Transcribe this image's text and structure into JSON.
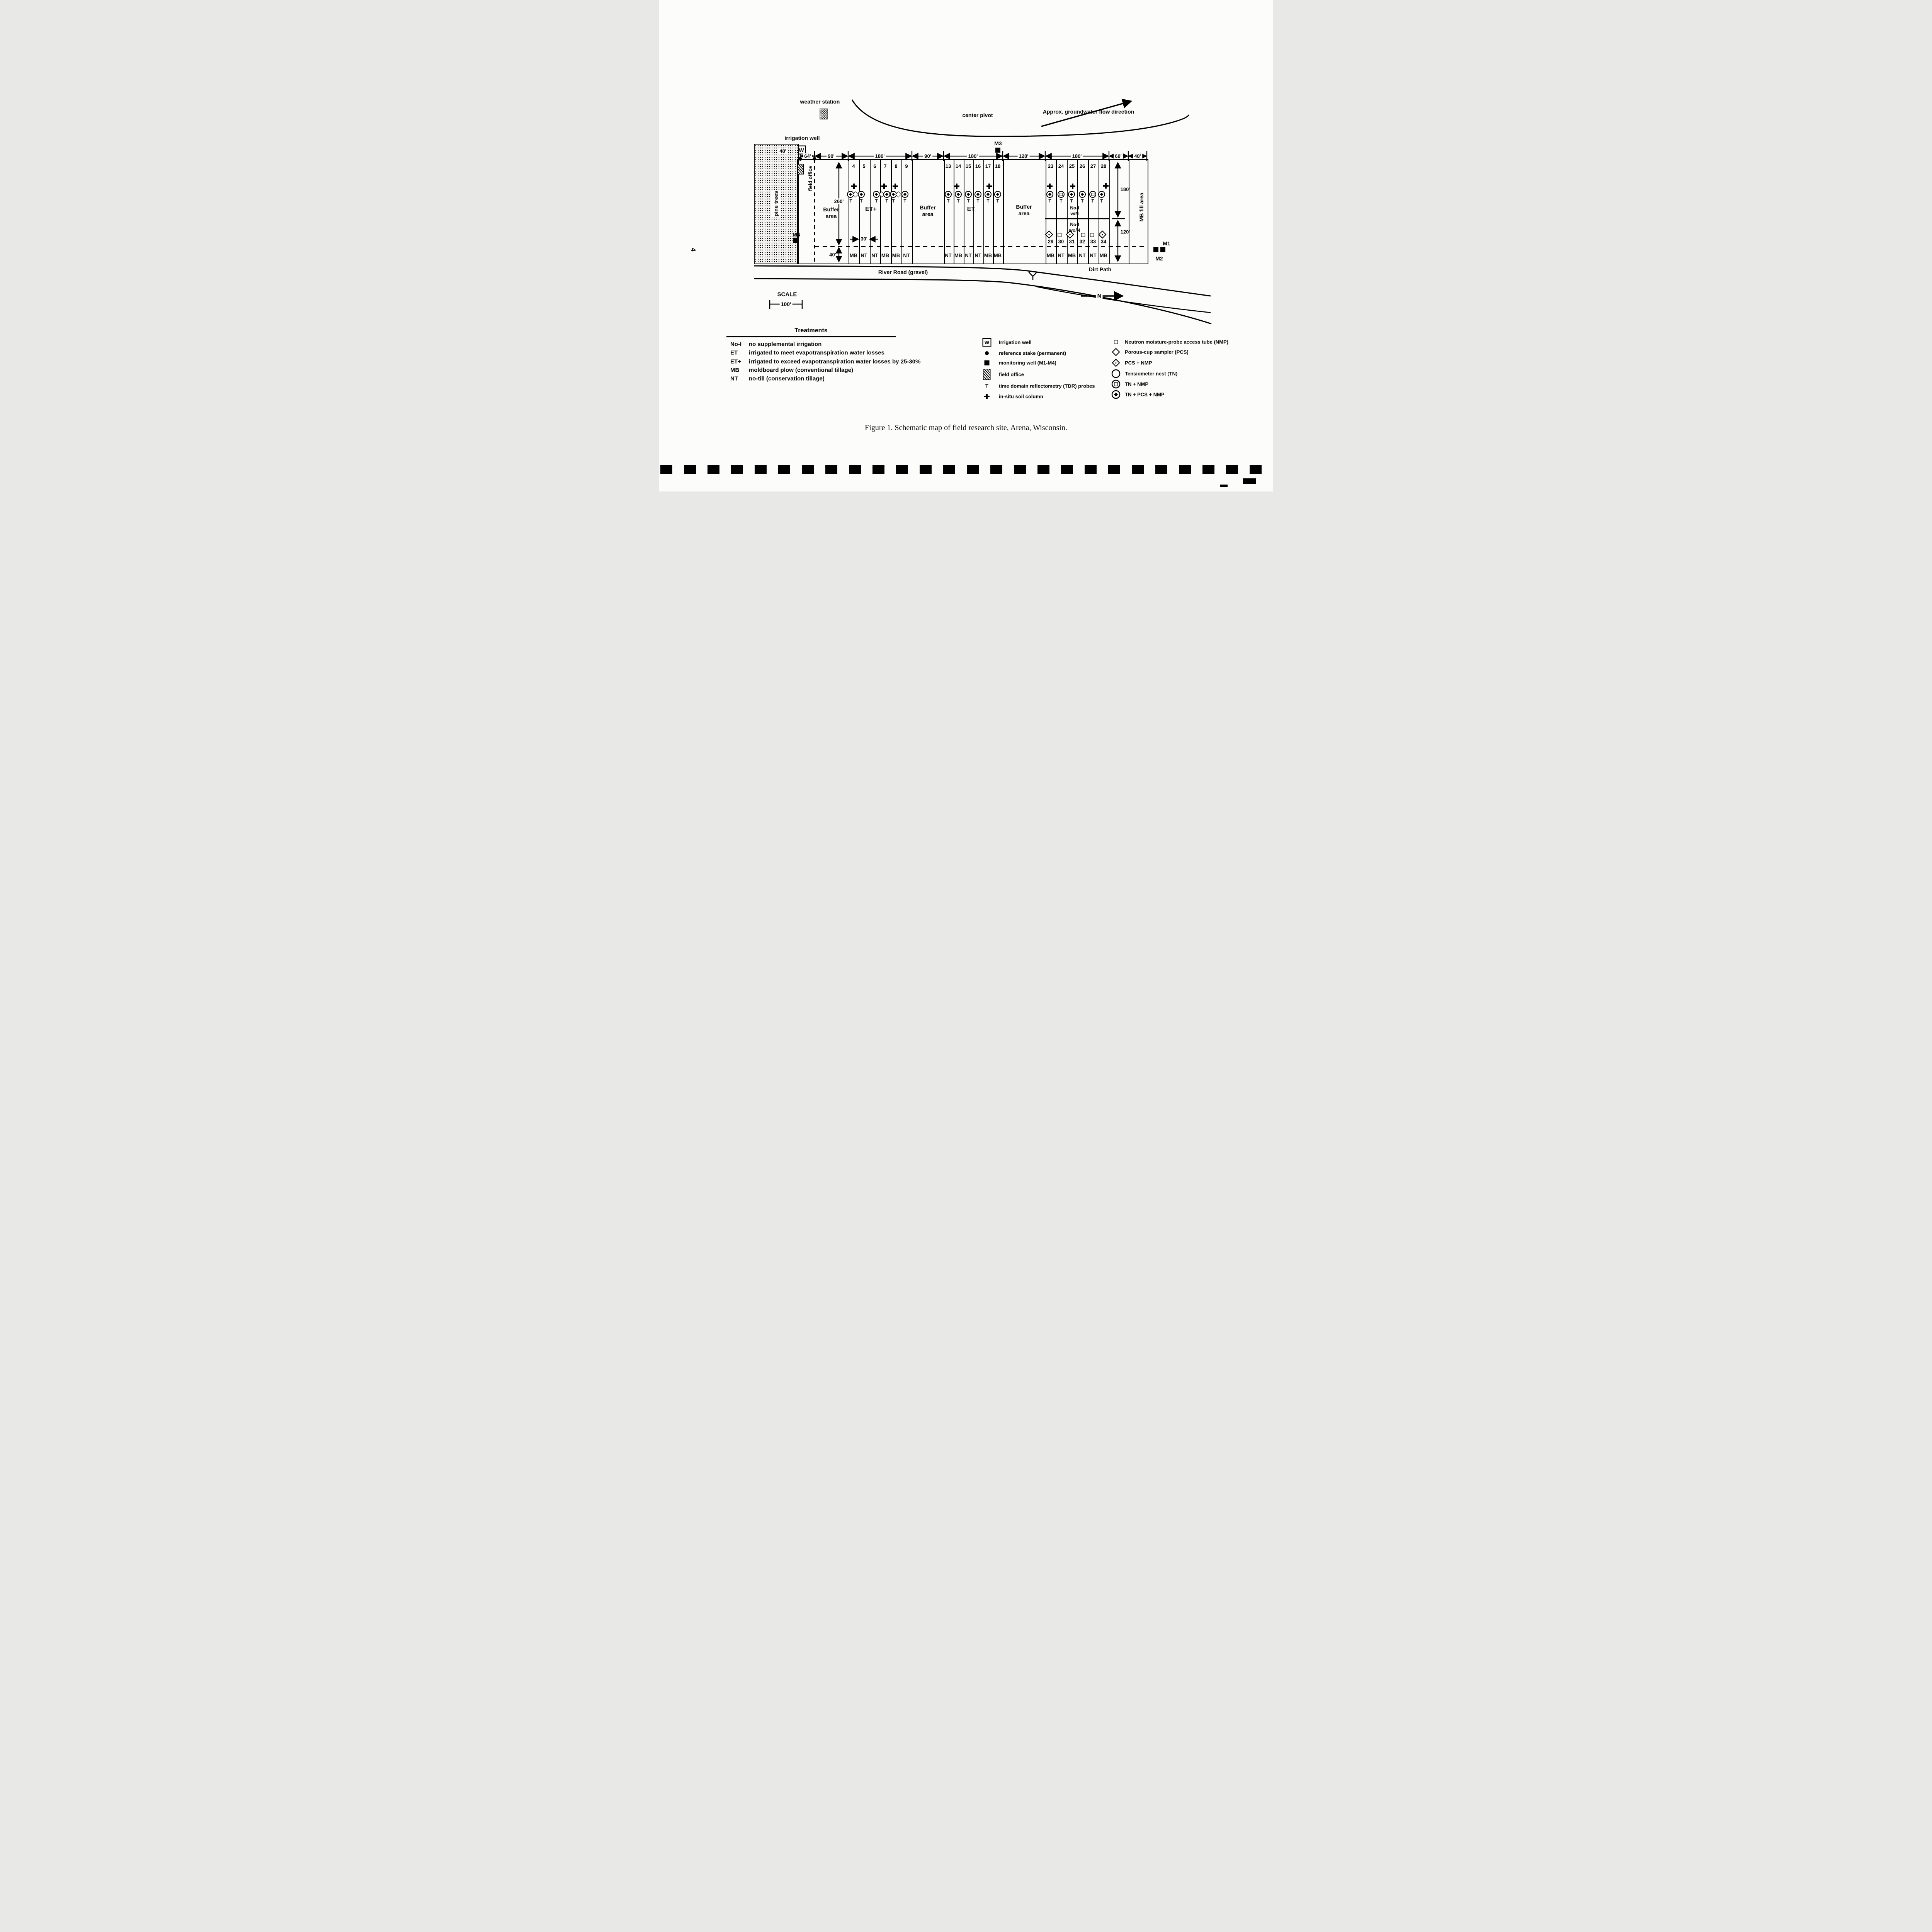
{
  "page": {
    "number": "4"
  },
  "map": {
    "labels": {
      "weather_station": "weather station",
      "irrigation_well": "irrigation well",
      "center_pivot": "center pivot",
      "groundwater_flow": "Approx. groundwater flow direction",
      "pine_trees": "pine trees",
      "field_office": "field office",
      "buffer_line1": "Buffer",
      "buffer_line2": "area",
      "et_plus": "ET+",
      "et": "ET",
      "noi_w_line1": "No-I",
      "noi_w_line2": "w/N",
      "noi_wo_line1": "No-I",
      "noi_wo_line2": "wo/N",
      "mb_fill_area": "MB fill area",
      "river_road": "River Road (gravel)",
      "dirt_path": "Dirt Path",
      "m1": "M1",
      "m2": "M2",
      "m3": "M3",
      "m4": "M4",
      "well_w": "W",
      "scale_title": "SCALE",
      "scale_length": "100'",
      "north": "N"
    },
    "dimensions": {
      "top": [
        "64'",
        "90'",
        "180'",
        "90'",
        "180'",
        "120'",
        "180'",
        "60'",
        "48'"
      ],
      "pine_width": "48'",
      "plot_length": "260'",
      "plot_width": "30'",
      "border_strip": "40'",
      "right_upper": "180'",
      "right_lower": "120'"
    },
    "plots": {
      "t_mark": "T",
      "et_plus_numbers": [
        "4",
        "5",
        "6",
        "7",
        "8",
        "9"
      ],
      "et_plus_tillage": [
        "MB",
        "NT",
        "NT",
        "MB",
        "MB",
        "NT"
      ],
      "et_numbers": [
        "13",
        "14",
        "15",
        "16",
        "17",
        "18"
      ],
      "et_tillage": [
        "NT",
        "MB",
        "NT",
        "NT",
        "MB",
        "MB"
      ],
      "noi_numbers": [
        "23",
        "24",
        "25",
        "26",
        "27",
        "28"
      ],
      "noi_lower_numbers": [
        "29",
        "30",
        "31",
        "32",
        "33",
        "34"
      ],
      "noi_tillage": [
        "MB",
        "NT",
        "MB",
        "NT",
        "NT",
        "MB"
      ]
    }
  },
  "treatments": {
    "title": "Treatments",
    "rows": [
      {
        "abbr": "No-I",
        "desc": "no supplemental irrigation"
      },
      {
        "abbr": "ET",
        "desc": "irrigated to meet evapotranspiration water losses"
      },
      {
        "abbr": "ET+",
        "desc": "irrigated to exceed evapotranspiration water losses by 25-30%"
      },
      {
        "abbr": "MB",
        "desc": "moldboard plow (conventional tillage)"
      },
      {
        "abbr": "NT",
        "desc": "no-till (conservation tillage)"
      }
    ]
  },
  "legend_site": {
    "items": [
      {
        "label": "Irrigation well"
      },
      {
        "label": "reference stake  (permanent)"
      },
      {
        "label": "monitoring well (M1-M4)"
      },
      {
        "label": "field office"
      },
      {
        "label": "time domain reflectometry (TDR) probes"
      },
      {
        "label": "in-situ soil column"
      }
    ]
  },
  "legend_instruments": {
    "items": [
      {
        "label": "Neutron moisture-probe access tube (NMP)"
      },
      {
        "label": "Porous-cup sampler (PCS)"
      },
      {
        "label": "PCS + NMP"
      },
      {
        "label": "Tensiometer nest (TN)"
      },
      {
        "label": "TN + NMP"
      },
      {
        "label": "TN + PCS + NMP"
      }
    ]
  },
  "caption": "Figure 1.  Schematic map of field research site, Arena, Wisconsin."
}
